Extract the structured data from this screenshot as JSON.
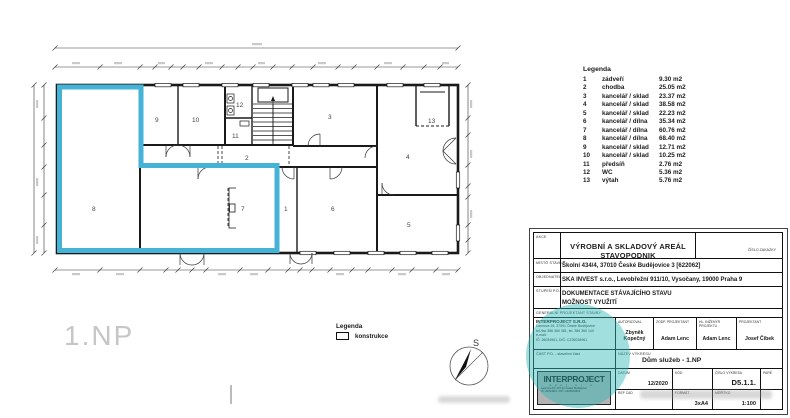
{
  "plan": {
    "floor_label": "1.NP",
    "compass_label": "S",
    "rooms": [
      {
        "num": "1"
      },
      {
        "num": "2"
      },
      {
        "num": "3"
      },
      {
        "num": "4"
      },
      {
        "num": "5"
      },
      {
        "num": "6"
      },
      {
        "num": "7"
      },
      {
        "num": "8"
      },
      {
        "num": "9"
      },
      {
        "num": "10"
      },
      {
        "num": "11"
      },
      {
        "num": "12"
      },
      {
        "num": "13"
      }
    ]
  },
  "legend": {
    "title": "Legenda",
    "items": [
      {
        "num": "1",
        "name": "zádveří",
        "area": "9.30 m2"
      },
      {
        "num": "2",
        "name": "chodba",
        "area": "25.05 m2"
      },
      {
        "num": "3",
        "name": "kancelář / sklad",
        "area": "23.37 m2"
      },
      {
        "num": "4",
        "name": "kancelář / sklad",
        "area": "38.58 m2"
      },
      {
        "num": "5",
        "name": "kancelář / sklad",
        "area": "22.23 m2"
      },
      {
        "num": "6",
        "name": "kancelář / dílna",
        "area": "35.34 m2"
      },
      {
        "num": "7",
        "name": "kancelář / dílna",
        "area": "60.76 m2"
      },
      {
        "num": "8",
        "name": "kancelář / dílna",
        "area": "68.40 m2"
      },
      {
        "num": "9",
        "name": "kancelář / sklad",
        "area": "12.71 m2"
      },
      {
        "num": "10",
        "name": "kancelář / sklad",
        "area": "10.25 m2"
      },
      {
        "num": "11",
        "name": "předsíň",
        "area": "2.76 m2"
      },
      {
        "num": "12",
        "name": "WC",
        "area": "5.36 m2"
      },
      {
        "num": "13",
        "name": "výtah",
        "area": "5.76 m2"
      }
    ]
  },
  "legend_konstrukce": {
    "title": "Legenda",
    "item": "konstrukce"
  },
  "titleblock": {
    "akce_label": "AKCE",
    "akce": "VÝROBNÍ A SKLADOVÝ AREÁL STAVOPODNIK",
    "cislo_zakazky_label": "ČÍSLO ZAKÁZKY",
    "misto_label": "MÍSTO STAVBY",
    "misto": "Školní 434/4, 37010 České Budějovice 3 [622062]",
    "objednatel_label": "OBJEDNATEL",
    "objednatel": "SKA INVEST s.r.o., Levobřežní 911/10, Vysočany, 19000 Praha 9",
    "stupen_label": "STUPEŇ P.D.",
    "stupen_line1": "DOKUMENTACE STÁVAJÍCÍHO STAVU",
    "stupen_line2": "MOŽNOST VYUŽITÍ",
    "gen_label": "GENERÁLNÍ PROJEKTANT STAVBY",
    "company": {
      "name": "INTERPROJECT S.R.O.",
      "addr": "Lannova 16, 37001 České Budějovice",
      "tel": "tel./fax 386 360 381, tel. 386 360 140",
      "email": "e-mail:",
      "ic": "IČ: 26034961, DIČ: CZ26034961"
    },
    "cols": [
      {
        "label": "AUTORIZOVAL",
        "value": "Zbyněk Kopečný"
      },
      {
        "label": "ZODP. PROJEKTANT",
        "value": "Adam Lenc"
      },
      {
        "label": "HL. INŽENÝR PROJEKTU",
        "value": "Adam Lenc"
      },
      {
        "label": "PROJEKTANT",
        "value": "Josef Čibek"
      }
    ],
    "cast_pd": "ČÁST P.D. - stavební část",
    "nazev_label": "NÁZEV VÝKRESU",
    "nazev": "Dům služeb - 1.NP",
    "datum_label": "DATUM",
    "datum": "12/2020",
    "kod_label": "KÓD",
    "cislo_vykresu_label": "ČÍSLO VÝKRESU",
    "cislo_vykresu": "D5.1.1.",
    "pare_label": "PARÉ",
    "refcad_label": "REF CAD",
    "format_label": "FORMÁT",
    "format": "3xA4",
    "meritko_label": "MĚŘÍTKO",
    "meritko": "1:100",
    "stamp": {
      "line1": "INTERPROJECT",
      "line2": "s p o l .  s  r . o .",
      "line3": "Lannova 16, 370 01 České Budějovice",
      "line4": "IČ: 26034961, DIČ: CZ26034961"
    }
  },
  "colors": {
    "highlight_cyan": "#45b3d6",
    "watermark_teal": "#2fb5b5",
    "line_black": "#1a1a1a",
    "floor_label_gray": "#c6c6c6"
  }
}
